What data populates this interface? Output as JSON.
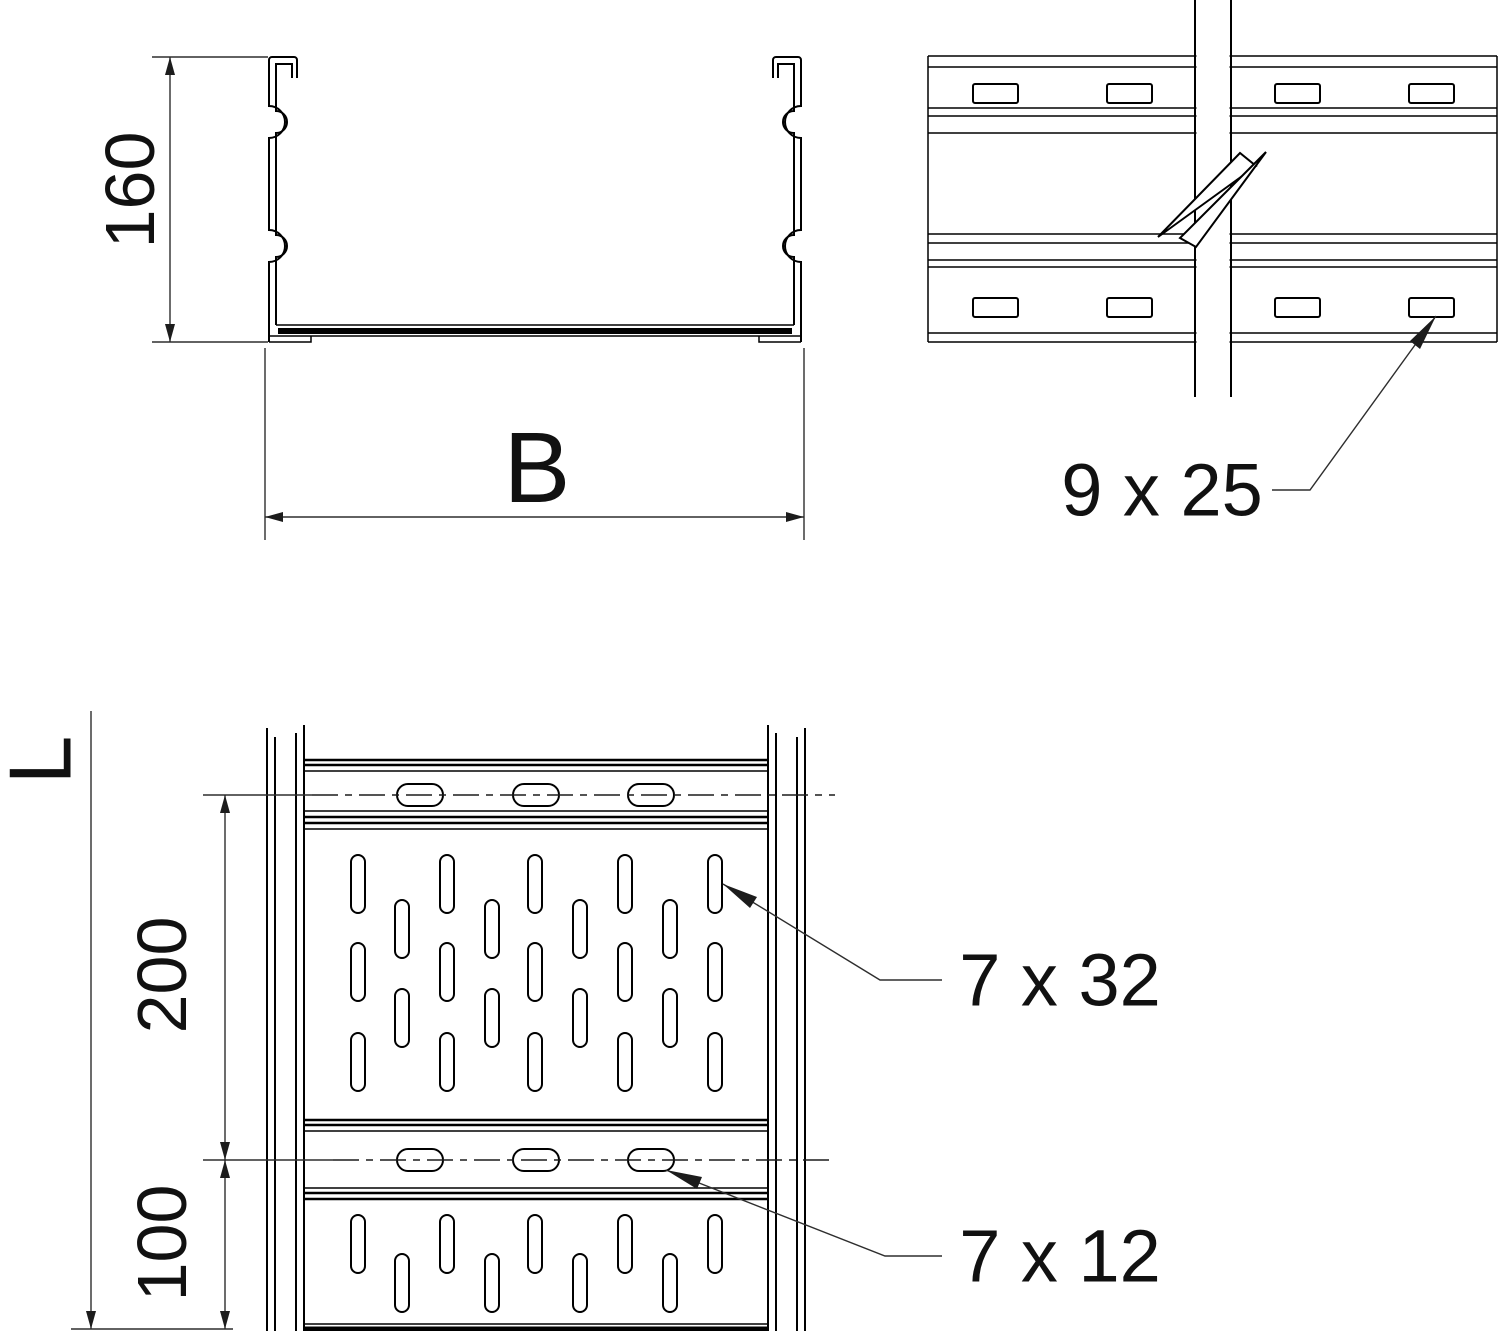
{
  "page": {
    "background": "#ffffff"
  },
  "drawing": {
    "colors": {
      "object_line": "#000000",
      "dimension_line": "#2e2e2e",
      "text": "#111111",
      "background": "#ffffff"
    },
    "cross_section": {
      "height": "160",
      "width": "B"
    },
    "side_view": {
      "slot_size": "9 x 25"
    },
    "plan_view": {
      "length": "L",
      "upper_spacing": "200",
      "lower_spacing": "100",
      "field_slot_size": "7 x 32",
      "rung_slot_size": "7 x 12"
    }
  }
}
